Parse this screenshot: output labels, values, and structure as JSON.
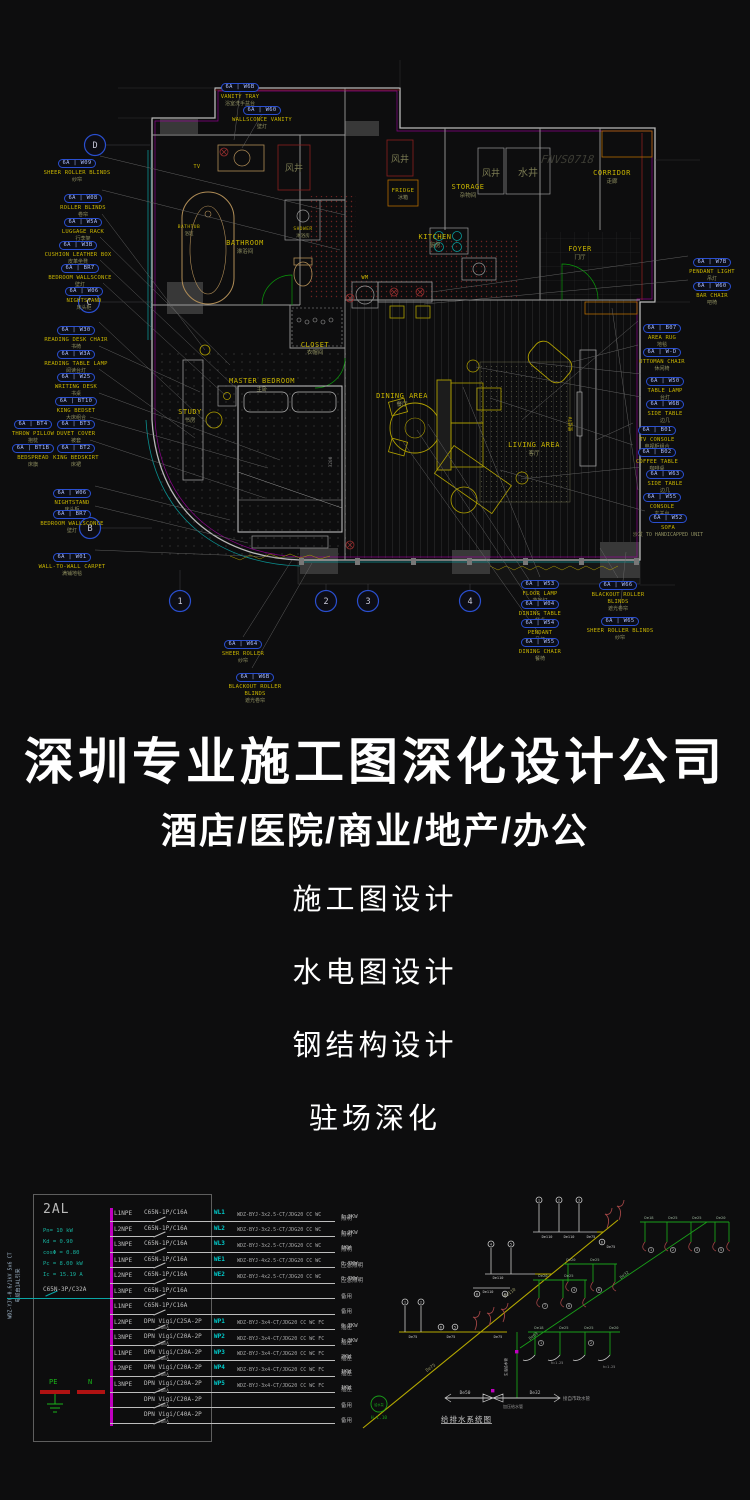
{
  "watermark": "FNVS0718",
  "plan": {
    "grid": {
      "rows": [
        "D",
        "C",
        "B"
      ],
      "cols": [
        "1",
        "2",
        "3",
        "4"
      ]
    },
    "rooms": {
      "bathroom": {
        "en": "BATHROOM",
        "cn": "淋浴间"
      },
      "bathtub": {
        "en": "BATHTUB",
        "cn": "浴缸"
      },
      "shower": {
        "en": "SHOWER",
        "cn": "淋浴房"
      },
      "closet": {
        "en": "CLOSET",
        "cn": "衣帽间"
      },
      "master_bedroom": {
        "en": "MASTER BEDROOM",
        "cn": "主卧"
      },
      "study": {
        "en": "STUDY",
        "cn": "书房"
      },
      "dining": {
        "en": "DINING AREA",
        "cn": "餐厅"
      },
      "living": {
        "en": "LIVING AREA",
        "cn": "客厅"
      },
      "kitchen": {
        "en": "KITCHEN",
        "cn": "厨房"
      },
      "storage": {
        "en": "STORAGE",
        "cn": "杂物间"
      },
      "foyer": {
        "en": "FOYER",
        "cn": "门厅"
      },
      "corridor": {
        "en": "CORRIDOR",
        "cn": "走廊"
      },
      "fridge": {
        "en": "FRIDGE",
        "cn": "冰箱"
      },
      "wm": {
        "en": "WM"
      },
      "tv": {
        "en": "TV"
      },
      "wall_tv": {
        "cn": "壁挂TV"
      },
      "shaft_air": "风井",
      "shaft_water": "水井",
      "dim": "3200"
    },
    "tags": [
      {
        "code": "6A | W09",
        "name": "SHEER ROLLER BLINDS",
        "cn": "纱帘"
      },
      {
        "code": "6A | W08",
        "name": "ROLLER BLINDS",
        "cn": "卷帘"
      },
      {
        "code": "6A | W5A",
        "name": "LUGGAGE RACK",
        "cn": "行李架"
      },
      {
        "code": "6A | W3B",
        "name": "CUSHION LEATHER BOX",
        "cn": "皮革坐凳"
      },
      {
        "code": "6A | BR7",
        "name": "BEDROOM WALLSCONCE",
        "cn": "壁灯"
      },
      {
        "code": "6A | W06",
        "name": "NIGHTSTAND",
        "cn": "床头柜"
      },
      {
        "code": "6A | W30",
        "name": "READING DESK CHAIR",
        "cn": "书椅"
      },
      {
        "code": "6A | W3A",
        "name": "READING TABLE LAMP",
        "cn": "阅读台灯"
      },
      {
        "code": "6A | W25",
        "name": "WRITING DESK",
        "cn": "书桌"
      },
      {
        "code": "6A | BT10",
        "name": "KING BEDSET",
        "cn": "大床组合"
      },
      {
        "code": "6A | BT4",
        "name": "THROW PILLOW",
        "cn": "抱枕"
      },
      {
        "code": "6A | BT3",
        "name": "DUVET COVER",
        "cn": "被套"
      },
      {
        "code": "6A | BT1B",
        "name": "BEDSPREAD",
        "cn": "床旗"
      },
      {
        "code": "6A | BT2",
        "name": "KING BEDSKIRT",
        "cn": "床裙"
      },
      {
        "code": "6A | W06",
        "name": "NIGHTSTAND",
        "cn": "床头柜"
      },
      {
        "code": "6A | BR7",
        "name": "BEDROOM WALLSCONCE",
        "cn": "壁灯"
      },
      {
        "code": "6A | W01",
        "name": "WALL-TO-WALL CARPET",
        "cn": "满铺地毯"
      },
      {
        "code": "6A | W6B",
        "name": "VANITY TRAY",
        "cn": "浴室洗手盆台"
      },
      {
        "code": "6A | W60",
        "name": "WALLSCONCE VANITY",
        "cn": "壁灯"
      },
      {
        "code": "6A | W7B",
        "name": "PENDANT LIGHT",
        "cn": "吊灯"
      },
      {
        "code": "6A | W60",
        "name": "BAR CHAIR",
        "cn": "吧椅"
      },
      {
        "code": "6A | B07",
        "name": "AREA RUG",
        "cn": "地毯"
      },
      {
        "code": "6A | W-D",
        "name": "OTTOMAN CHAIR",
        "cn": "休闲椅"
      },
      {
        "code": "6A | W50",
        "name": "TABLE LAMP",
        "cn": "台灯"
      },
      {
        "code": "6A | W6B",
        "name": "SIDE TABLE",
        "cn": "边几"
      },
      {
        "code": "6A | B01",
        "name": "TV CONSOLE",
        "cn": "电视柜组合"
      },
      {
        "code": "6A | B02",
        "name": "COFFEE TABLE",
        "cn": "咖啡桌"
      },
      {
        "code": "6A | W63",
        "name": "SIDE TABLE",
        "cn": "边几"
      },
      {
        "code": "6A | W55",
        "name": "CONSOLE",
        "cn": "玄关台"
      },
      {
        "code": "6A | W52",
        "name": "SOFA",
        "cn": "沙发 TO HANDICAPPED UNIT"
      },
      {
        "code": "6A | W64",
        "name": "SHEER ROLLER",
        "cn": "纱帘"
      },
      {
        "code": "6A | W6B",
        "name": "BLACKOUT ROLLER BLINDS",
        "cn": "遮光卷帘"
      },
      {
        "code": "6A | W53",
        "name": "FLOOR LAMP",
        "cn": "落地灯"
      },
      {
        "code": "6A | W04",
        "name": "DINING TABLE",
        "cn": "餐桌"
      },
      {
        "code": "6A | W54",
        "name": "PENDANT",
        "cn": "吊灯"
      },
      {
        "code": "6A | W55",
        "name": "DINING CHAIR",
        "cn": "餐椅"
      },
      {
        "code": "6A | W66",
        "name": "BLACKOUT ROLLER BLINDS",
        "cn": "遮光卷帘"
      },
      {
        "code": "6A | W65",
        "name": "SHEER ROLLER BLINDS",
        "cn": "纱帘"
      }
    ]
  },
  "middle": {
    "title": "深圳专业施工图深化设计公司",
    "subtitle": "酒店/医院/商业/地产/办公",
    "services": [
      "施工图设计",
      "水电图设计",
      "钢结构设计",
      "驻场深化"
    ]
  },
  "panel": {
    "name": "2AL",
    "params": [
      "Pn= 10 kW",
      "Kd = 0.90",
      "cosΦ = 0.80",
      "Pc = 8.00 kW",
      "Ic = 15.19 A"
    ],
    "feeder_cable": "WDZ-YJY-0.6/1kV 5x6 CT",
    "feeder_note": "电缆由1AL引来",
    "incoming_breaker": "C65N-3P/C32A",
    "pe_label": "PE",
    "n_label": "N",
    "circuits": [
      {
        "phase": "L1NPE",
        "breaker": "C65N-1P/C16A",
        "rcd": "",
        "id": "WL1",
        "cable": "WDZ-BYJ-3x2.5-CT/JDG20 CC WC",
        "load": "照明",
        "kw": "1.3KW"
      },
      {
        "phase": "L2NPE",
        "breaker": "C65N-1P/C16A",
        "rcd": "",
        "id": "WL2",
        "cable": "WDZ-BYJ-3x2.5-CT/JDG20 CC WC",
        "load": "照明",
        "kw": "1.2KW"
      },
      {
        "phase": "L3NPE",
        "breaker": "C65N-1P/C16A",
        "rcd": "",
        "id": "WL3",
        "cable": "WDZ-BYJ-3x2.5-CT/JDG20 CC WC",
        "load": "照明",
        "kw": "1KW"
      },
      {
        "phase": "L1NPE",
        "breaker": "C65N-1P/C16A",
        "rcd": "",
        "id": "WE1",
        "cable": "WDZ-BYJ-4x2.5-CT/JDG20 CC WC",
        "load": "应急照明",
        "kw": "0.7KW"
      },
      {
        "phase": "L2NPE",
        "breaker": "C65N-1P/C16A",
        "rcd": "",
        "id": "WE2",
        "cable": "WDZ-BYJ-4x2.5-CT/JDG20 CC WC",
        "load": "应急照明",
        "kw": "0.7KW"
      },
      {
        "phase": "L3NPE",
        "breaker": "C65N-1P/C16A",
        "rcd": "",
        "id": "",
        "cable": "",
        "load": "备用",
        "kw": ""
      },
      {
        "phase": "L1NPE",
        "breaker": "C65N-1P/C16A",
        "rcd": "",
        "id": "",
        "cable": "",
        "load": "备用",
        "kw": ""
      },
      {
        "phase": "L2NPE",
        "breaker": "DPN Vigi/C25A-2P",
        "rcd": "30mA",
        "id": "WP1",
        "cable": "WDZ-BYJ-3x4-CT/JDG20 CC WC FC",
        "load": "插座",
        "kw": "0.7KW"
      },
      {
        "phase": "L3NPE",
        "breaker": "DPN Vigi/C20A-2P",
        "rcd": "30mA",
        "id": "WP2",
        "cable": "WDZ-BYJ-3x4-CT/JDG20 CC WC FC",
        "load": "插座",
        "kw": "1.3KW"
      },
      {
        "phase": "L1NPE",
        "breaker": "DPN Vigi/C20A-2P",
        "rcd": "30mA",
        "id": "WP3",
        "cable": "WDZ-BYJ-3x4-CT/JDG20 CC WC FC",
        "load": "插座",
        "kw": "2KW"
      },
      {
        "phase": "L2NPE",
        "breaker": "DPN Vigi/C20A-2P",
        "rcd": "30mA",
        "id": "WP4",
        "cable": "WDZ-BYJ-3x4-CT/JDG20 CC WC FC",
        "load": "插座",
        "kw": "1KW"
      },
      {
        "phase": "L3NPE",
        "breaker": "DPN Vigi/C20A-2P",
        "rcd": "30mA",
        "id": "WP5",
        "cable": "WDZ-BYJ-3x4-CT/JDG20 CC WC FC",
        "load": "插座",
        "kw": "1KW"
      },
      {
        "phase": "",
        "breaker": "DPN Vigi/C20A-2P",
        "rcd": "30mA",
        "id": "",
        "cable": "",
        "load": "备用",
        "kw": ""
      },
      {
        "phase": "",
        "breaker": "DPN Vigi/C40A-2P",
        "rcd": "30mA",
        "id": "",
        "cable": "",
        "load": "备用",
        "kw": ""
      }
    ]
  },
  "riser": {
    "title": "给排水系统图",
    "pump_text": "给水泵",
    "pump_tag": "H-1.10",
    "labels": {
      "main_hi": "De110",
      "main_lo": "De75",
      "wA1": "De110",
      "wA2": "De110",
      "wA3": "De75",
      "wA4": "De75",
      "wB1": "De110",
      "wB2": "De110",
      "wC1": "De75",
      "wC2": "De75",
      "wC3": "De75",
      "gmain_lo": "De63",
      "gmain_hi": "De32",
      "gt1": "De18",
      "gt2": "De25",
      "gt3": "De25",
      "gt4": "De20",
      "gm1": "De20",
      "gm2": "De25",
      "gm3": "De20",
      "gm4": "De25",
      "gl1": "De18",
      "gl2": "De25",
      "gl3": "De25",
      "gl4": "De20",
      "pipe_note": "生活给水管",
      "b_left": "De50",
      "b_right": "De32",
      "b_note": "接自市政水管",
      "b_under": "加压给水管",
      "h1": "h=1.25",
      "h2": "h=1.25"
    }
  },
  "colors": {
    "wall": "#b9b9b9",
    "accent_magenta": "#a000a0",
    "accent_red": "#8b2020",
    "accent_green": "#0a9a0a",
    "accent_cyan": "#0a9090",
    "furniture": "#b0a000",
    "label_yellow": "#c8b400",
    "tag_blue": "#2a4fd0",
    "bus_magenta": "#c000c0",
    "param_teal": "#17b3a0",
    "pipe_green": "#19a019",
    "pipe_yellow": "#b5a900"
  }
}
